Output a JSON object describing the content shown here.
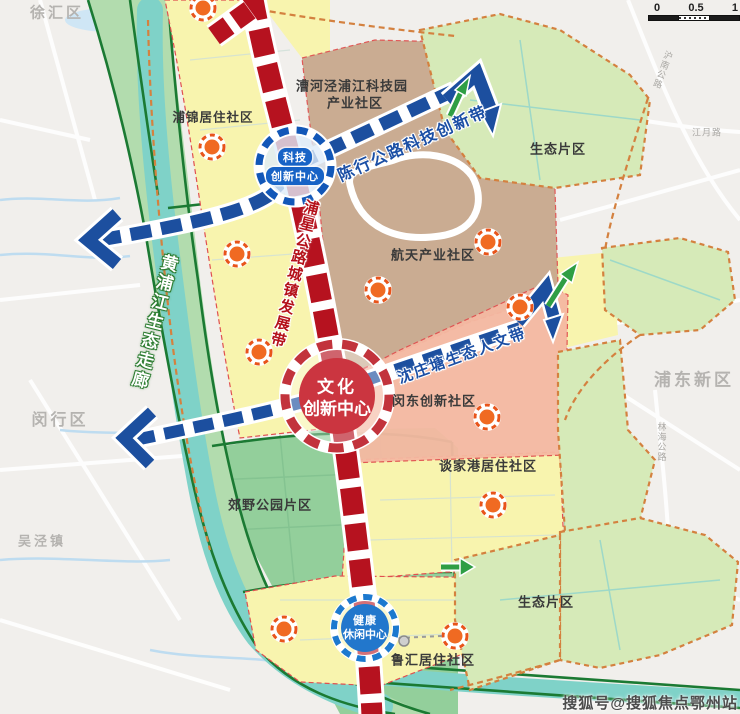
{
  "map": {
    "outside_labels": {
      "xuhui": "徐汇区",
      "minhang": "闵行区",
      "wujing": "吴泾镇",
      "pudong": "浦东新区"
    },
    "region_labels": {
      "pujin": "浦锦居住社区",
      "caohejing_l1": "漕河泾浦江科技园",
      "caohejing_l2": "产业社区",
      "eco_ne": "生态片区",
      "hangtian": "航天产业社区",
      "mindong": "闵东创新社区",
      "tanjiagang": "谈家港居住社区",
      "jiaoye": "郊野公园片区",
      "eco_se": "生态片区",
      "luhui": "鲁汇居住社区"
    },
    "corridor_labels": {
      "chenhang": "陈行公路科技创新带",
      "shenzhuangtang": "沈庄塘生态人文带",
      "puxing": "浦星公路城镇发展带",
      "huangpu": "黄浦江生态走廊"
    },
    "road_labels": {
      "hunan": "沪南公路",
      "jiangyue": "江月路",
      "linhai": "林海公路"
    },
    "centers": {
      "tech": {
        "l1": "科技",
        "l2": "创新中心"
      },
      "culture": {
        "l1": "文化",
        "l2": "创新中心"
      },
      "health": {
        "l1": "健康",
        "l2": "休闲中心"
      }
    },
    "scalebar": {
      "t0": "0",
      "t1": "0.5",
      "t2": "1"
    },
    "watermark": "搜狐号@搜狐焦点鄂州站",
    "colors": {
      "red_band": "#b6121f",
      "blue_corridor": "#1c4f9f",
      "green_arrow": "#2f9e44",
      "node_orange": "#f06a22",
      "residential_yellow": "#f8f4ae",
      "industry_brown": "#c8a98e",
      "innovation_pink": "#f5b9a2",
      "eco_green": "#d6eab8",
      "park_green": "#93cf9b",
      "river_teal": "#7fd2c8"
    }
  }
}
